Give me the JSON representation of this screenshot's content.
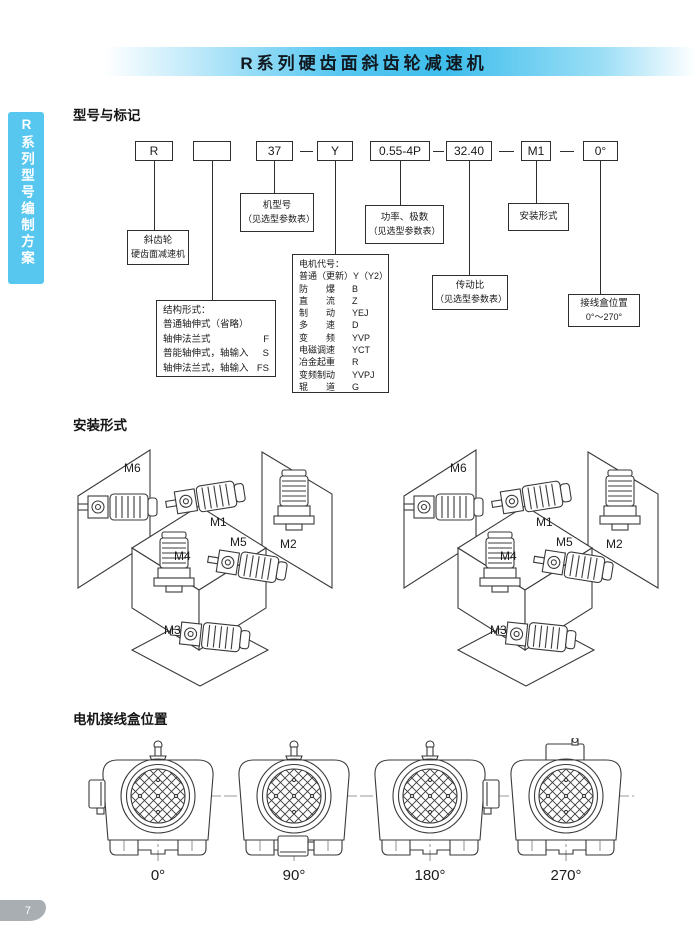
{
  "header": {
    "title": "R系列硬齿面斜齿轮减速机"
  },
  "sidebar": {
    "label": "R系列型号编制方案"
  },
  "page_number": "7",
  "model_section": {
    "heading": "型号与标记",
    "code_boxes": [
      "R",
      "",
      "37",
      "Y",
      "0.55-4P",
      "32.40",
      "M1",
      "0°"
    ],
    "callouts": {
      "reducer": {
        "line1": "斜齿轮",
        "line2": "硬齿面减速机"
      },
      "model_no": {
        "line1": "机型号",
        "line2": "（见选型参数表）"
      },
      "power": {
        "line1": "功率、极数",
        "line2": "（见选型参数表）"
      },
      "ratio": {
        "line1": "传动比",
        "line2": "（见选型参数表）"
      },
      "mounting": {
        "line1": "安装形式"
      },
      "terminal": {
        "line1": "接线盒位置",
        "line2": "0°～270°"
      },
      "structure": {
        "title": "结构形式：",
        "rows": [
          {
            "name": "普通轴伸式（省略）",
            "code": ""
          },
          {
            "name": "轴伸法兰式",
            "code": "F"
          },
          {
            "name": "普能轴伸式，轴输入",
            "code": "S"
          },
          {
            "name": "轴伸法兰式，轴输入",
            "code": "FS"
          }
        ]
      },
      "motor": {
        "title": "电机代号：",
        "rows": [
          {
            "name": "普通（更新）",
            "code": "Y（Y2）"
          },
          {
            "name": "防　　爆",
            "code": "B"
          },
          {
            "name": "直　　流",
            "code": "Z"
          },
          {
            "name": "制　　动",
            "code": "YEJ"
          },
          {
            "name": "多　　速",
            "code": "D"
          },
          {
            "name": "变　　频",
            "code": "YVP"
          },
          {
            "name": "电磁调速",
            "code": "YCT"
          },
          {
            "name": "冶金起重",
            "code": "R"
          },
          {
            "name": "变频制动",
            "code": "YVPJ"
          },
          {
            "name": "辊　　道",
            "code": "G"
          }
        ]
      }
    }
  },
  "mounting_section": {
    "heading": "安装形式",
    "labels": [
      "M6",
      "M1",
      "M2",
      "M4",
      "M5",
      "M3"
    ]
  },
  "terminal_section": {
    "heading": "电机接线盒位置",
    "positions": [
      {
        "label": "0°",
        "junction_box": "left"
      },
      {
        "label": "90°",
        "junction_box": "bottom"
      },
      {
        "label": "180°",
        "junction_box": "right"
      },
      {
        "label": "270°",
        "junction_box": "top"
      }
    ]
  },
  "colors": {
    "accent_blue": "#45c1ee",
    "sidebar_blue": "#57c7f0",
    "footer_gray": "#a9aeb2"
  }
}
